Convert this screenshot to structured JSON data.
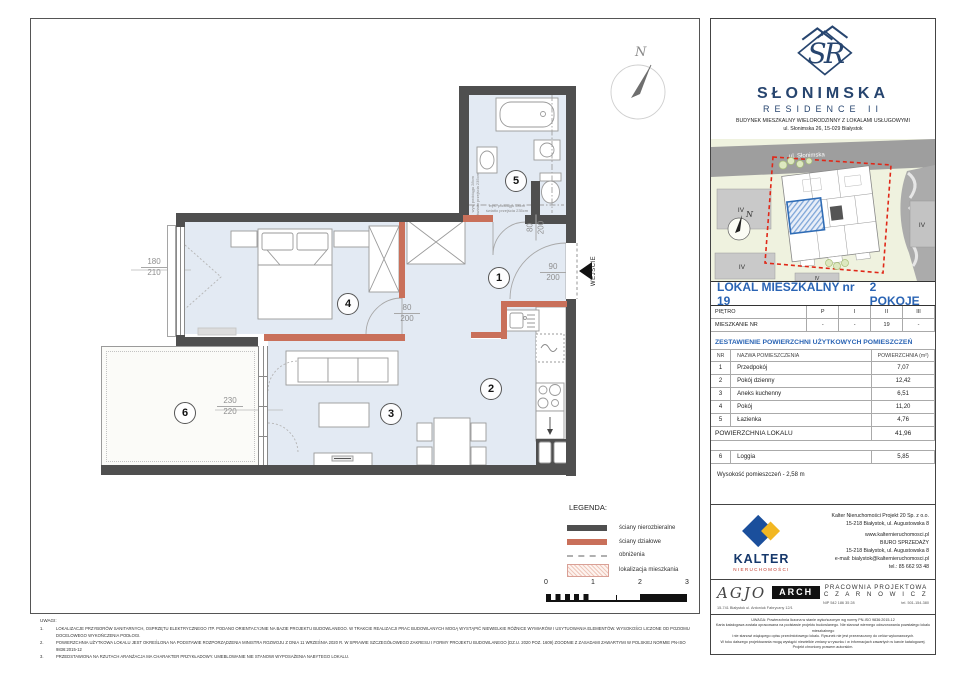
{
  "plan": {
    "north": "N",
    "entrance": "WEJŚCIE",
    "rooms": [
      "1",
      "2",
      "3",
      "4",
      "5",
      "6"
    ],
    "dims": {
      "bedroom_window": {
        "a": "180",
        "b": "210"
      },
      "loggia_door": {
        "a": "230",
        "b": "220"
      },
      "bedroom_door": {
        "a": "80",
        "b": "200"
      },
      "bath_door": {
        "a": "80",
        "b": "200"
      },
      "entrance_door": {
        "a": "90",
        "b": "200"
      }
    },
    "beam_note": {
      "l1": "wys. podciągu 28cm",
      "l2": "światło przejścia 235cm"
    }
  },
  "legend": {
    "title": "LEGENDA:",
    "items": [
      "ściany nierozbieralne",
      "ściany działowe",
      "obniżenia",
      "lokalizacja mieszkania"
    ],
    "scale": [
      "0",
      "1",
      "2",
      "3"
    ]
  },
  "notes": {
    "title": "UWAGI:",
    "items": [
      {
        "no": "1.",
        "text": "LOKALIZACJE PRZYBORÓW SANITARNYCH, OSPRZĘTU ELEKTRYCZNEGO ITP. PODANO ORIENTACYJNIE NA BAZIE PROJEKTU BUDOWLANEGO. W TRAKCIE REALIZACJI PRAC BUDOWLANYCH MOGĄ WYSTĄPIĆ NIEWIELKIE RÓŻNICE WYMIARÓW I USYTUOWANIA ELEMENTÓW. WYSOKOŚCI LICZONE OD POZIOMU DOCELOWEGO WYKOŃCZENIA PODŁOGI."
      },
      {
        "no": "2.",
        "text": "POWIERZCHNIA UŻYTKOWA LOKALU JEST OKREŚLONA NA PODSTAWIE ROZPORZĄDZENIA MINISTRA ROZWOJU Z DNIA 11 WRZEŚNIA 2020 R. W SPRAWIE SZCZEGÓŁOWEGO ZAKRESU I FORMY PROJEKTU BUDOWLANEGO (DZ.U. 2020 POZ. 1609) ZGODNIE Z ZASADAMI ZAWARTYMI W POLSKIEJ NORMIE PN-ISO 9836:2015-12"
      },
      {
        "no": "3.",
        "text": "PRZEDSTAWIONA NA RZUTACH ARANŻACJA MA CHARAKTER PRZYKŁADOWY. UMEBLOWANIE NIE STANOWI WYPOSAŻENIA NABYTEGO LOKALU."
      }
    ]
  },
  "panel": {
    "logo": {
      "monogram": "SR",
      "roman": "II",
      "name": "SŁONIMSKA",
      "residence": "RESIDENCE II",
      "desc": "BUDYNEK MIESZKALNY WIELORODZINNY Z LOKALAMI USŁUGOWYMI",
      "address": "ul. Słonimska 26, 15-029 Białystok"
    },
    "map": {
      "street": "ul. Słonimska",
      "iv": "IV",
      "north": "N"
    },
    "unit": {
      "title": "LOKAL MIESZKALNY  nr 19",
      "type": "2 POKOJE"
    },
    "floors": {
      "label1": "PIĘTRO",
      "c1": "P",
      "c2": "I",
      "c3": "II",
      "c4": "III",
      "label2": "MIESZKANIE NR",
      "v1": "-",
      "v2": "-",
      "v3": "19",
      "v4": "-"
    },
    "area_header": "ZESTAWIENIE POWIERZCHNI UŻYTKOWYCH POMIESZCZEŃ",
    "table": {
      "h_nr": "NR",
      "h_name": "NAZWA POMIESZCZENIA",
      "h_area": "POWIERZCHNIA (m²)",
      "rows": [
        {
          "nr": "1",
          "name": "Przedpokój",
          "area": "7,07"
        },
        {
          "nr": "2",
          "name": "Pokój dzienny",
          "area": "12,42"
        },
        {
          "nr": "3",
          "name": "Aneks kuchenny",
          "area": "6,51"
        },
        {
          "nr": "4",
          "name": "Pokój",
          "area": "11,20"
        },
        {
          "nr": "5",
          "name": "Łazienka",
          "area": "4,76"
        }
      ],
      "total_label": "POWIERZCHNIA LOKALU",
      "total": "41,96",
      "loggia": {
        "nr": "6",
        "name": "Loggia",
        "area": "5,85"
      },
      "height": "Wysokość pomieszczeń - 2,58 m"
    },
    "kalter": {
      "name": "KALTER",
      "sub": "NIERUCHOMOŚCI",
      "lines": [
        "Kalter Nieruchomości Projekt 20  Sp. z o.o.",
        "15-218 Białystok, ul. Augustowska 8",
        "www.kalternieruchomosci.pl",
        "BIURO SPRZEDAŻY",
        "15-218 Białystok, ul. Augustowska 8",
        "e-mail: bialystok@kalternieruchomosci.pl",
        "tel.: 85 662 93 48"
      ]
    },
    "arch": {
      "agjo": "AGJO",
      "arch": "ARCH",
      "address": "15-741 Białystok   ul. Antoniuk Fabryczny  12/1",
      "studio1": "PRACOWNIA PROJEKTOWA",
      "studio2": "C Z A R N O W I C Z",
      "nip": "NIP  542 186 35 28",
      "tel": "tel. 501-154-380"
    },
    "disclaimer": [
      "UWAGA:  Powierzchnia liczona w stanie wykończonym wg normy PN-ISO 9836:2015-12",
      "Karta katalogowa została opracowana na podstawie projektu budowlanego.  Nie stanowi wiernego odwzorowania powstałego lokalu mieszkalnego",
      "i nie stanowi wiążącego opisu przedmiotowego lokalu. Rysunek nie jest przeznaczony do celów wykonawczych.",
      "W toku dalszego projektowania mogą wystąpić niewielkie zmiany w rysunku i w informacjach zawartych w karcie katalogowej. Projekt chroniony prawem autorskim."
    ]
  },
  "colors": {
    "wall": "#4f4f4f",
    "partition": "#c9705a",
    "floor": "#e3eaf3",
    "accent_blue": "#2a64b4",
    "logo_navy": "#27456f",
    "kalter_blue": "#1b4f9c",
    "kalter_yellow": "#f2b722",
    "kalter_red": "#c0392b",
    "map_red": "#e02818"
  }
}
